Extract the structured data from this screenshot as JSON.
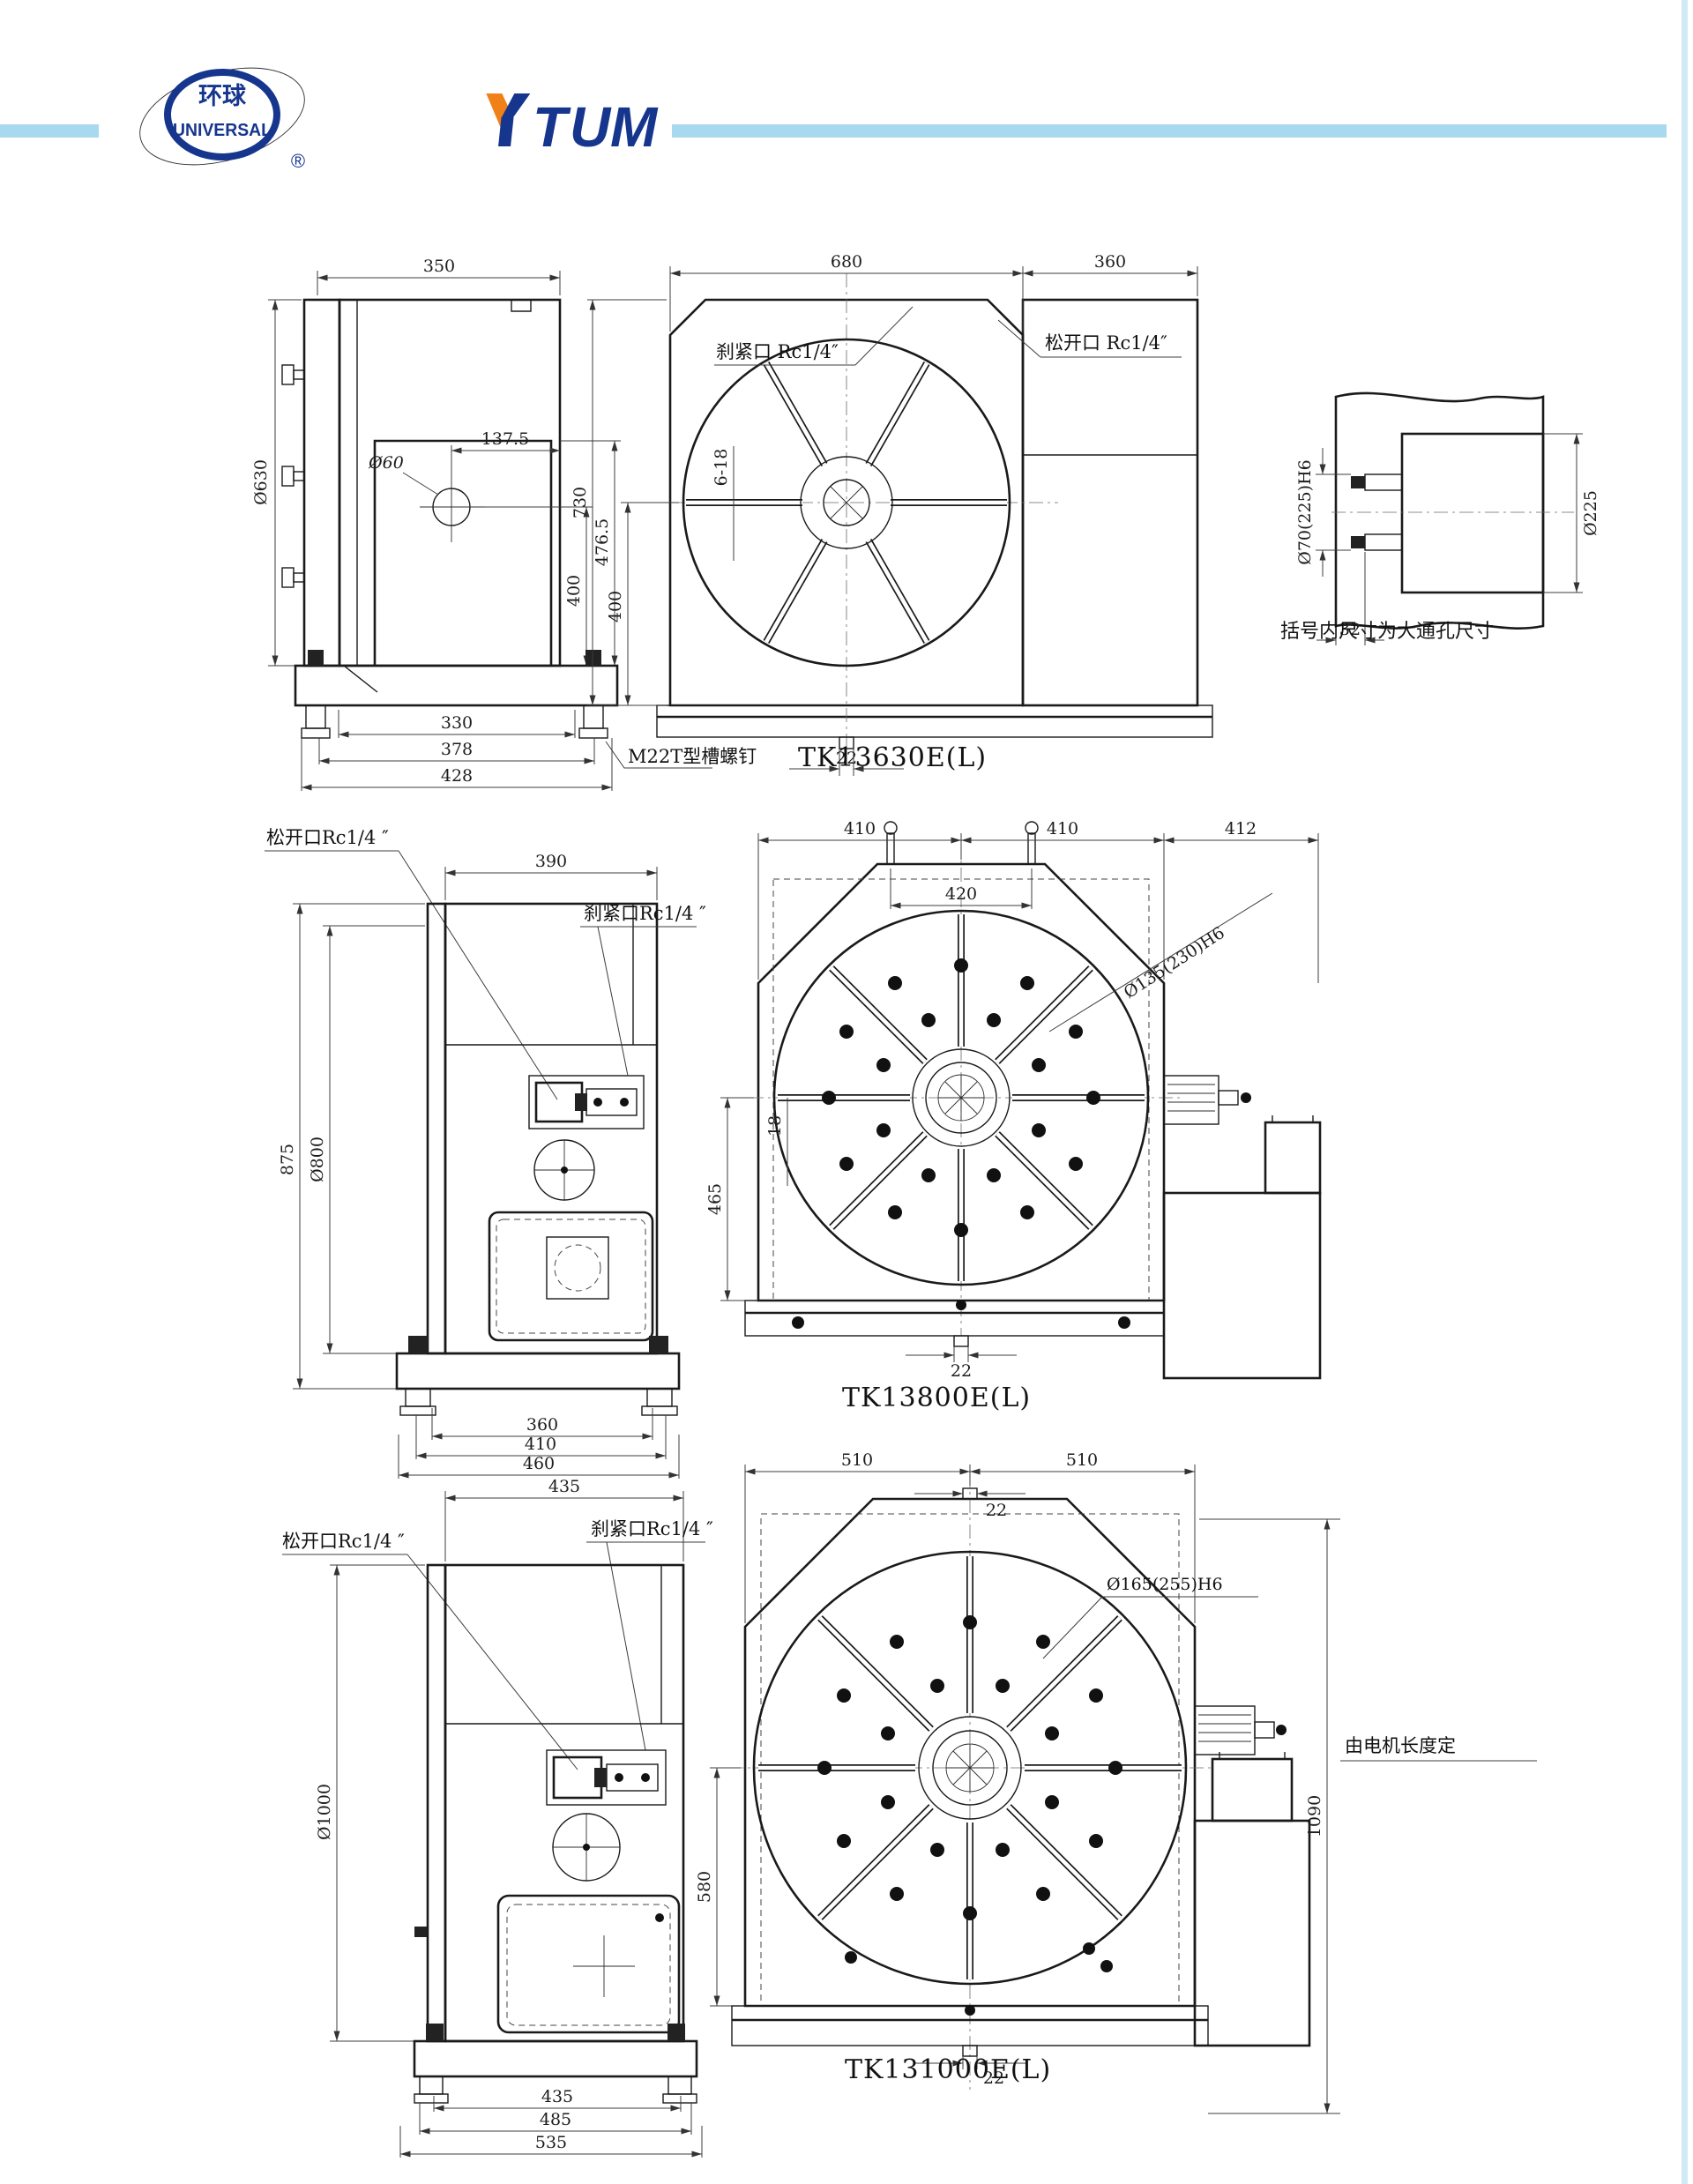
{
  "header": {
    "logo_cn": "环球",
    "logo_en": "UNIVERSAL",
    "logo_r": "®",
    "brand_t": "T",
    "brand_u": "U",
    "brand_m": "M",
    "colors": {
      "brand_blue": "#16368e",
      "accent_orange": "#f08119",
      "bar_teal": "#a9d9ee"
    }
  },
  "note": "括号内尺寸为大通孔尺寸",
  "s1": {
    "title": "TK13630E(L)",
    "side": {
      "w350": "350",
      "d1375": "137.5",
      "d60": "Ø60",
      "d630": "Ø630",
      "h400": "400",
      "h4765": "476.5",
      "b330": "330",
      "b378": "378",
      "b428": "428",
      "leader": "M22T型槽螺钉"
    },
    "plan": {
      "w680": "680",
      "w360": "360",
      "h730": "730",
      "h400": "400",
      "slot": "6-18",
      "k22": "22",
      "clamp": "刹紧口 Rc1/4″",
      "release": "松开口 Rc1/4″"
    },
    "detail": {
      "bore": "Ø70(225)H6",
      "outer": "Ø225",
      "w32": "32"
    }
  },
  "s2": {
    "title": "TK13800E(L)",
    "side": {
      "w390": "390",
      "release": "松开口Rc1/4 ″",
      "clamp": "刹紧口Rc1/4 ″",
      "h875": "875",
      "d800": "Ø800",
      "b360": "360",
      "b410": "410",
      "b460": "460"
    },
    "plan": {
      "wl": "410",
      "wr": "410",
      "wm": "412",
      "w420": "420",
      "bore": "Ø135(230)H6",
      "slot": "18",
      "h465": "465",
      "k22": "22"
    }
  },
  "s3": {
    "title": "TK131000E(L)",
    "side": {
      "w435": "435",
      "release": "松开口Rc1/4 ″",
      "clamp": "刹紧口Rc1/4 ″",
      "d1000": "Ø1000",
      "b435": "435",
      "b485": "485",
      "b535": "535"
    },
    "plan": {
      "wl": "510",
      "wr": "510",
      "k22t": "22",
      "bore": "Ø165(255)H6",
      "h1090": "1090",
      "h580": "580",
      "k22": "22",
      "motor": "由电机长度定"
    }
  }
}
